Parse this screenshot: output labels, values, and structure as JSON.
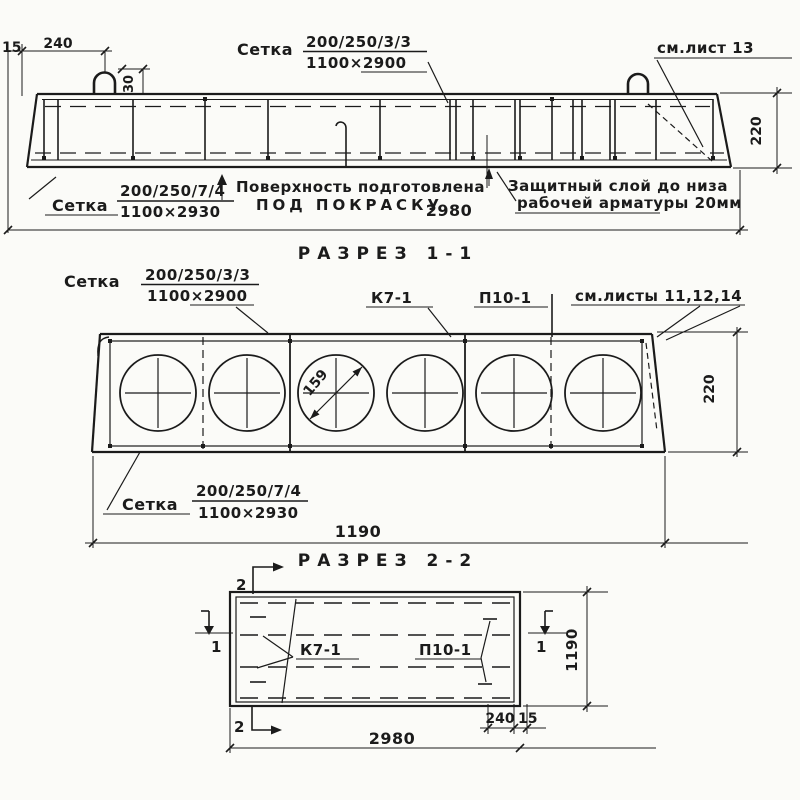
{
  "colors": {
    "ink": "#1b1b1b",
    "paper": "#fbfbf8"
  },
  "section_1_1": {
    "title": "РАЗРЕЗ 1-1",
    "dims": {
      "edge": "15",
      "loop_offset": "240",
      "loop_width": "30",
      "height": "220",
      "length": "2980"
    },
    "mesh_top": {
      "label": "Сетка",
      "spec": "200/250/3/3",
      "size": "1100×2900"
    },
    "mesh_bottom": {
      "label": "Сетка",
      "spec": "200/250/7/4",
      "size": "1100×2930"
    },
    "note_see_sheet": "см.лист 13",
    "note_surface_1": "Поверхность подготовлена",
    "note_surface_2": "ПОД ПОКРАСКУ",
    "note_cover_1": "Защитный слой до низа",
    "note_cover_2": "рабочей арматуры 20мм"
  },
  "section_2_2": {
    "title": "РАЗРЕЗ 2-2",
    "dims": {
      "height": "220",
      "width": "1190",
      "core_diameter": "159"
    },
    "mesh_top": {
      "label": "Сетка",
      "spec": "200/250/3/3",
      "size": "1100×2900"
    },
    "mesh_bottom": {
      "label": "Сетка",
      "spec": "200/250/7/4",
      "size": "1100×2930"
    },
    "label_k7": "К7-1",
    "label_p10": "П10-1",
    "note_see_sheets": "см.листы 11,12,14"
  },
  "plan": {
    "label_k7": "К7-1",
    "label_p10": "П10-1",
    "section_mark_1": "1",
    "section_mark_2": "2",
    "dims": {
      "width": "1190",
      "length": "2980",
      "end_offset": "240",
      "edge": "15"
    }
  }
}
